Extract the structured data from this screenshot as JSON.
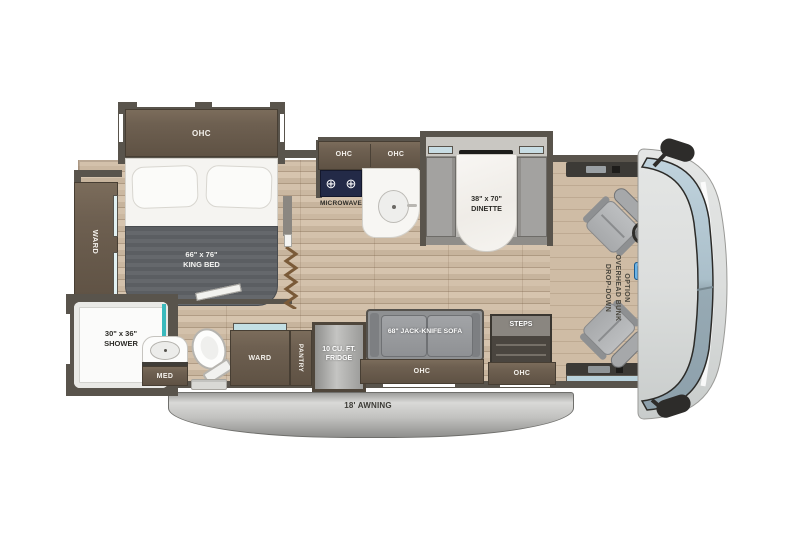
{
  "labels": {
    "bed_ohc": "OHC",
    "king_bed_size": "66\" x 76\"",
    "king_bed_name": "KING BED",
    "ward_left": "WARD",
    "shower_size": "30\" x 36\"",
    "shower_name": "SHOWER",
    "med": "MED",
    "kitchen_ohc_left": "OHC",
    "kitchen_ohc_right": "OHC",
    "microwave": "MICROWAVE",
    "tv": "39\" TV",
    "dinette_size": "38\" x 70\"",
    "dinette_name": "DINETTE",
    "bunk_line1": "DROP-DOWN",
    "bunk_line2": "OVERHEAD BUNK",
    "bunk_line3": "OPTION",
    "ward_bottom": "WARD",
    "pantry": "PANTRY",
    "fridge": "10 CU. FT.\nFRIDGE",
    "sofa": "68\" JACK-KNIFE SOFA",
    "steps": "STEPS",
    "sofa_ohc": "OHC",
    "steps_ohc": "OHC",
    "awning": "18' AWNING"
  },
  "colors": {
    "wall": "#59544c",
    "cabinet_wood": "#6e6051",
    "floor_wood": "#ccb9a2",
    "mattress_gray": "#5c5f63",
    "accent_teal": "#3ab9bd",
    "cooktop_navy": "#232a47",
    "windshield_blue": "#a9bfcc",
    "seat_gray": "#b2b4b6",
    "awning_silver": "#c6c6c6"
  }
}
